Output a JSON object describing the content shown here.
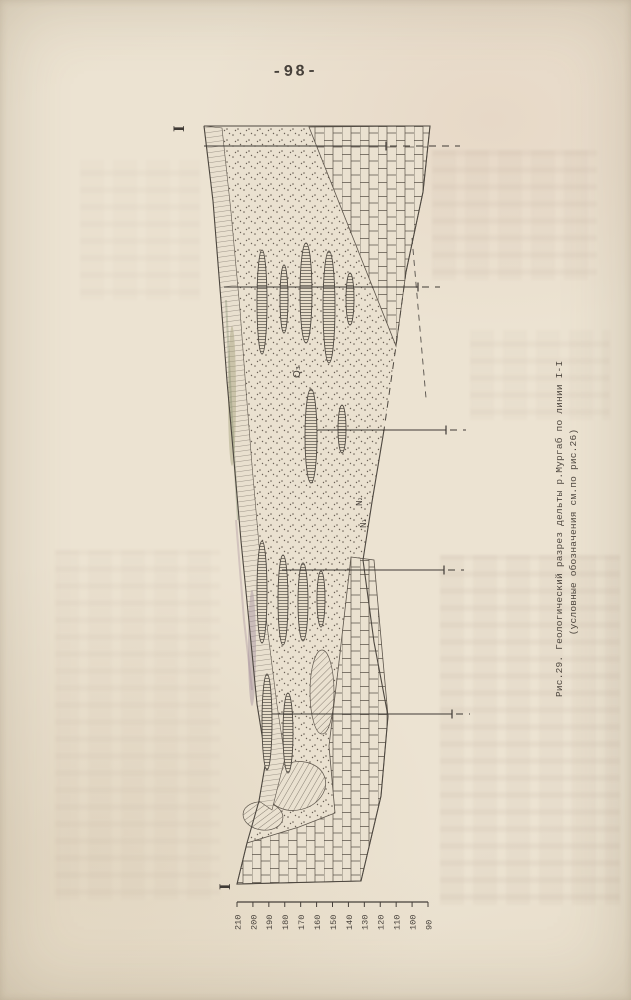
{
  "page": {
    "number": "-98-",
    "paper_color": "#ece3d2",
    "ink_color": "#46403a"
  },
  "figure": {
    "caption_line1": "Рис.29. Геологический разрез дельты р.Мургаб по линии I-I",
    "caption_line2": "(условные обозначения см.по рис.26)",
    "section_markers": [
      {
        "text": "I",
        "x": 184,
        "y": 132
      },
      {
        "text": "I",
        "x": 230,
        "y": 890
      }
    ],
    "strata_labels": [
      {
        "text": "Q₃",
        "x": 300,
        "y": 378,
        "size": 10
      },
      {
        "text": "N₂",
        "x": 362,
        "y": 506,
        "size": 7.5
      },
      {
        "text": "N₁",
        "x": 366,
        "y": 528,
        "size": 7.5
      }
    ],
    "boreholes": [
      {
        "y": 146,
        "x1": 204,
        "x2": 386,
        "x3": 460
      },
      {
        "y": 287,
        "x1": 224,
        "x2": 418,
        "x3": 440
      },
      {
        "y": 430,
        "x1": 318,
        "x2": 446,
        "x3": 466
      },
      {
        "y": 570,
        "x1": 282,
        "x2": 444,
        "x3": 464
      },
      {
        "y": 714,
        "x1": 272,
        "x2": 452,
        "x3": 470
      }
    ],
    "lenses": [
      [
        262,
        302,
        5,
        52
      ],
      [
        284,
        299,
        4,
        34
      ],
      [
        306,
        293,
        6,
        50
      ],
      [
        329,
        307,
        6,
        56
      ],
      [
        350,
        299,
        4,
        26
      ],
      [
        311,
        436,
        6,
        47
      ],
      [
        342,
        429,
        4,
        24
      ],
      [
        262,
        592,
        5,
        51
      ],
      [
        283,
        600,
        5,
        45
      ],
      [
        303,
        602,
        5,
        39
      ],
      [
        321,
        599,
        4,
        28
      ],
      [
        267,
        722,
        5,
        48
      ],
      [
        288,
        733,
        5,
        40
      ]
    ],
    "elevation_scale": {
      "values": [
        210,
        200,
        190,
        180,
        170,
        160,
        150,
        140,
        130,
        120,
        110,
        100,
        90
      ],
      "x_start": 237,
      "x_end": 428,
      "y": 902
    }
  }
}
